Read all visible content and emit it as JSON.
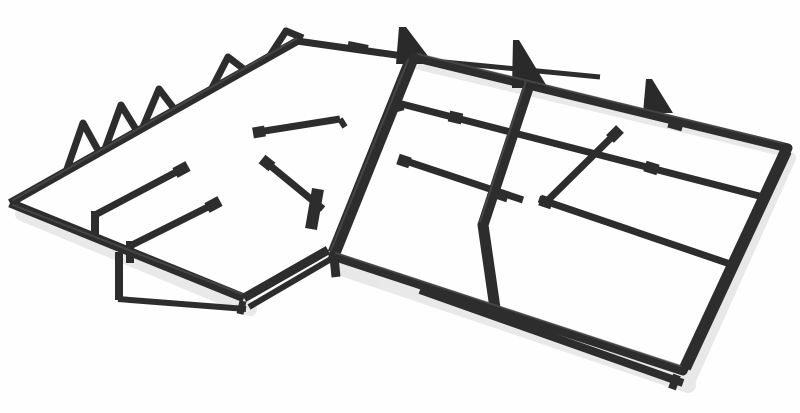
{
  "meta": {
    "description": "Product photo: two black cast-iron gas hob pan-support grates placed side by side on a white background, viewed in perspective",
    "objects": [
      {
        "label": "left pan support grate",
        "teeth_count": 5,
        "support_pads": 4
      },
      {
        "label": "right pan support grate",
        "burner_openings": 2,
        "support_fins": 3,
        "inner_rails": 3
      }
    ]
  },
  "scene": {
    "background_color": "#fefefe",
    "iron_color": "#2d2d2d",
    "iron_fill_color": "#2a2a2a",
    "highlight_color": "#595959",
    "shadow_color": "#b9b9b9"
  }
}
